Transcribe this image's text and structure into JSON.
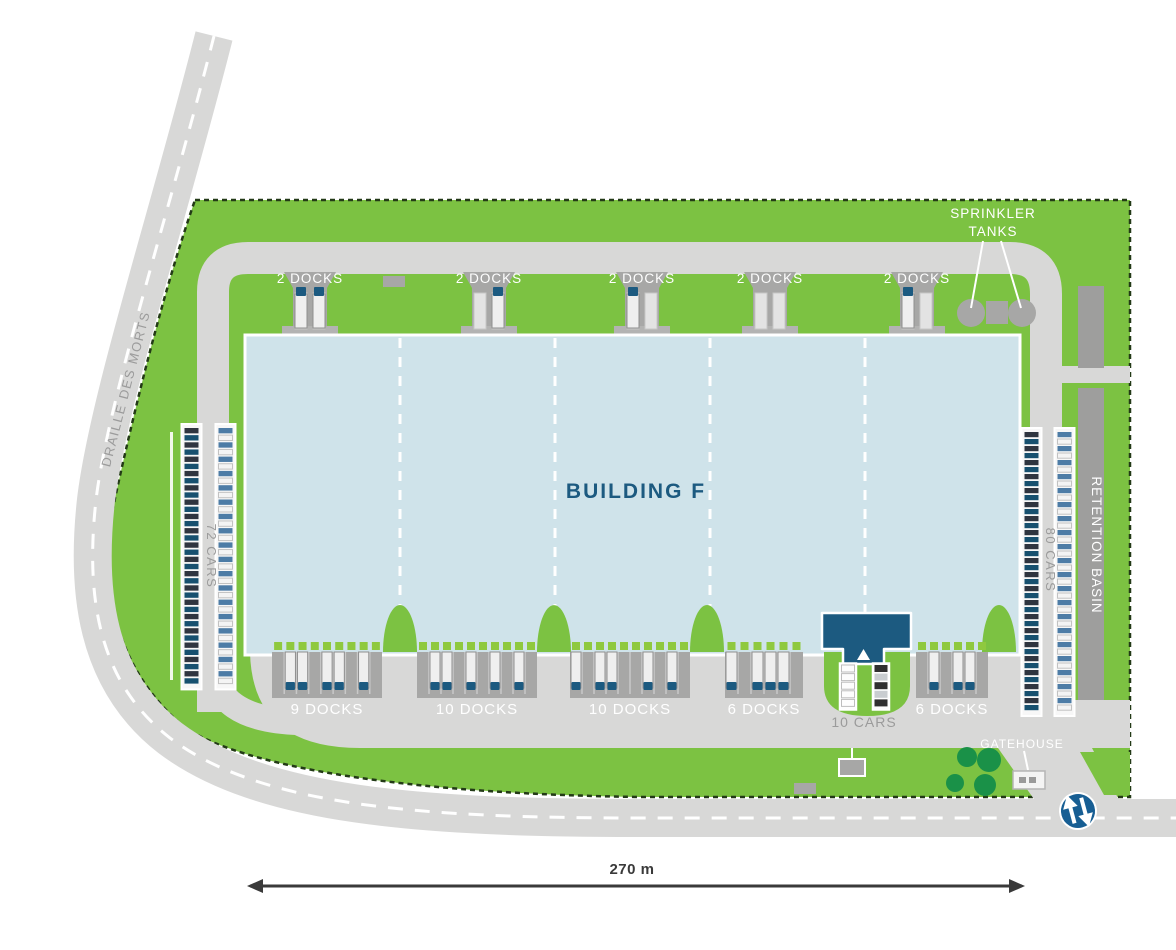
{
  "palette": {
    "green": "#7cc242",
    "door_green": "#8fc93f",
    "road": "#d8d8d7",
    "pad": "#a7a7a6",
    "pad_base": "#b3b3b2",
    "basin": "#9e9e9d",
    "building": "#cfe3ea",
    "dark_blue": "#1c5a80",
    "compass_blue": "#175e93",
    "tree": "#1a9148",
    "label_gray": "#9b9b9b",
    "boundary": "#233a17",
    "dim": "#3a3a3a",
    "trailer": "#efefef",
    "trailer_stroke": "#8f8f8f",
    "empty_slot": "#e3e3e3",
    "car_colors": [
      "#2f3540",
      "#4d7ca6",
      "#c9cdd0",
      "#17506f",
      "#f4f4f4",
      "#303030"
    ]
  },
  "labels": {
    "building": "BUILDING F",
    "road_name": "DRAILLE DES MORTS",
    "sprinkler": [
      "SPRINKLER",
      "TANKS"
    ],
    "retention_basin": "RETENTION BASIN",
    "gatehouse": "GATEHOUSE",
    "scale": "270 m"
  },
  "top_docks": {
    "label": "2 DOCKS",
    "pockets": [
      {
        "trucks": [
          true,
          true
        ]
      },
      {
        "trucks": [
          false,
          true
        ]
      },
      {
        "trucks": [
          true,
          false
        ]
      },
      {
        "trucks": [
          false,
          false
        ]
      },
      {
        "trucks": [
          true,
          false
        ]
      }
    ]
  },
  "bottom_docks": [
    {
      "label": "9 DOCKS",
      "docks": 9,
      "trucks": [
        1,
        2,
        4,
        5,
        7
      ]
    },
    {
      "label": "10 DOCKS",
      "docks": 10,
      "trucks": [
        1,
        2,
        4,
        6,
        8
      ]
    },
    {
      "label": "10 DOCKS",
      "docks": 10,
      "trucks": [
        0,
        2,
        3,
        6,
        8
      ]
    },
    {
      "label": "6 DOCKS",
      "docks": 6,
      "trucks": [
        0,
        2,
        3,
        4
      ]
    },
    {
      "label": "6 DOCKS",
      "docks": 6,
      "trucks": [
        1,
        3,
        4
      ]
    }
  ],
  "parking": {
    "left": {
      "label": "72 CARS",
      "cars": 72
    },
    "right": {
      "label": "80 CARS",
      "cars": 80
    },
    "center": {
      "label": "10 CARS",
      "cars": 10
    }
  }
}
